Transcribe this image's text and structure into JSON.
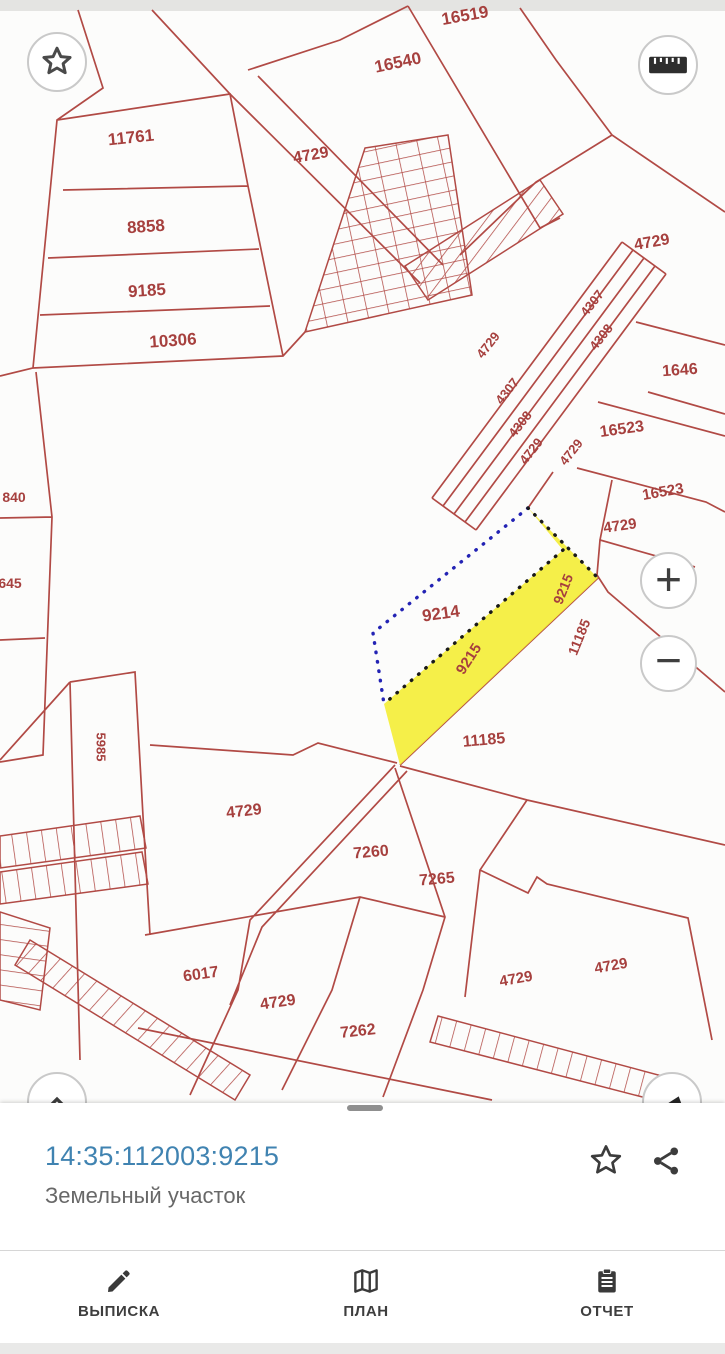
{
  "map": {
    "colors": {
      "line": "#b14a45",
      "label": "#a6403e",
      "selected_fill": "#f4ee3a",
      "dot_blue": "#2323b4",
      "dot_black": "#191919",
      "background": "#fcfcfb",
      "title_blue": "#4083b1"
    },
    "selected_parcel_number": "9215",
    "labels": [
      {
        "text": "16519",
        "x": 465,
        "y": 16,
        "rot": -10,
        "size": 17
      },
      {
        "text": "16540",
        "x": 398,
        "y": 63,
        "rot": -12,
        "size": 17
      },
      {
        "text": "11761",
        "x": 131,
        "y": 138,
        "rot": -6,
        "size": 17
      },
      {
        "text": "4729",
        "x": 311,
        "y": 156,
        "rot": -10,
        "size": 16
      },
      {
        "text": "8858",
        "x": 146,
        "y": 227,
        "rot": -4,
        "size": 17
      },
      {
        "text": "9185",
        "x": 147,
        "y": 291,
        "rot": -4,
        "size": 17
      },
      {
        "text": "10306",
        "x": 173,
        "y": 341,
        "rot": -4,
        "size": 17
      },
      {
        "text": "4729",
        "x": 652,
        "y": 243,
        "rot": -10,
        "size": 16
      },
      {
        "text": "4307",
        "x": 592,
        "y": 303,
        "rot": -52,
        "size": 13
      },
      {
        "text": "4308",
        "x": 601,
        "y": 337,
        "rot": -52,
        "size": 13
      },
      {
        "text": "4729",
        "x": 488,
        "y": 345,
        "rot": -52,
        "size": 13
      },
      {
        "text": "4307",
        "x": 507,
        "y": 391,
        "rot": -52,
        "size": 13
      },
      {
        "text": "4308",
        "x": 520,
        "y": 424,
        "rot": -52,
        "size": 13
      },
      {
        "text": "4729",
        "x": 531,
        "y": 451,
        "rot": -52,
        "size": 13
      },
      {
        "text": "4729",
        "x": 571,
        "y": 452,
        "rot": -52,
        "size": 13
      },
      {
        "text": "1646",
        "x": 680,
        "y": 371,
        "rot": -4,
        "size": 16
      },
      {
        "text": "16523",
        "x": 622,
        "y": 430,
        "rot": -8,
        "size": 16
      },
      {
        "text": "16523",
        "x": 663,
        "y": 492,
        "rot": -10,
        "size": 15
      },
      {
        "text": "4729",
        "x": 620,
        "y": 526,
        "rot": -8,
        "size": 15
      },
      {
        "text": "9214",
        "x": 441,
        "y": 614,
        "rot": -8,
        "size": 17
      },
      {
        "text": "9215",
        "x": 469,
        "y": 659,
        "rot": -57,
        "size": 15
      },
      {
        "text": "9215",
        "x": 563,
        "y": 589,
        "rot": -68,
        "size": 14
      },
      {
        "text": "11185",
        "x": 579,
        "y": 637,
        "rot": -68,
        "size": 14
      },
      {
        "text": "11185",
        "x": 484,
        "y": 741,
        "rot": -5,
        "size": 16
      },
      {
        "text": "5985",
        "x": 101,
        "y": 747,
        "rot": 90,
        "size": 13
      },
      {
        "text": "840",
        "x": 14,
        "y": 497,
        "rot": 0,
        "size": 14
      },
      {
        "text": "645",
        "x": 10,
        "y": 583,
        "rot": 0,
        "size": 14
      },
      {
        "text": "4729",
        "x": 244,
        "y": 812,
        "rot": -6,
        "size": 16
      },
      {
        "text": "7260",
        "x": 371,
        "y": 853,
        "rot": -5,
        "size": 16
      },
      {
        "text": "7265",
        "x": 437,
        "y": 880,
        "rot": -5,
        "size": 16
      },
      {
        "text": "6017",
        "x": 201,
        "y": 975,
        "rot": -8,
        "size": 16
      },
      {
        "text": "4729",
        "x": 278,
        "y": 1003,
        "rot": -8,
        "size": 16
      },
      {
        "text": "7262",
        "x": 358,
        "y": 1032,
        "rot": -6,
        "size": 16
      },
      {
        "text": "4729",
        "x": 516,
        "y": 979,
        "rot": -10,
        "size": 15
      },
      {
        "text": "4729",
        "x": 611,
        "y": 966,
        "rot": -10,
        "size": 15
      }
    ]
  },
  "controls": {
    "zoom_in": "+",
    "zoom_out": "−"
  },
  "bottom_sheet": {
    "title": "14:35:112003:9215",
    "subtitle": "Земельный участок"
  },
  "bottom_nav": {
    "items": [
      {
        "label": "ВЫПИСКА",
        "icon": "pencil-icon"
      },
      {
        "label": "ПЛАН",
        "icon": "map-icon"
      },
      {
        "label": "ОТЧЕТ",
        "icon": "clipboard-icon"
      }
    ]
  }
}
